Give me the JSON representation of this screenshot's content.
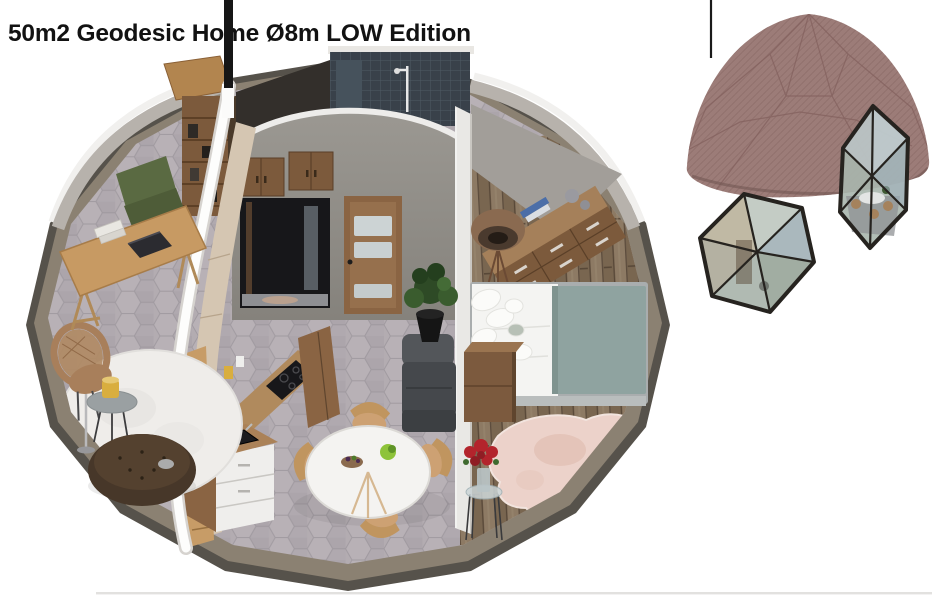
{
  "title": "50m2 Geodesic Home Ø8m LOW Edition",
  "colors": {
    "background": "#ffffff",
    "title_ink": "#121212",
    "mast": "#161616",
    "rim_edge": "#56524b",
    "rim_band": "#8b8172",
    "tile_floor": "#b3acb1",
    "wall_gray": "#918e89",
    "cut_white": "#fdfdfc",
    "wood_furniture": "#a97f55",
    "wood_dark": "#7c5a3c",
    "olive": "#5a6a42",
    "pouf": "#473729",
    "blanket": "#8fa3a0",
    "linen": "#f4f4f2",
    "shower": "#39414a",
    "glass": "#ccd3d4",
    "flower_red": "#b3242c",
    "dome_shell": "#9c7c78",
    "dome_frame": "#26231f",
    "cowhide": "#ecd2ca",
    "rattan": "#a87f5b",
    "lamp_yellow": "#d9ae3f"
  }
}
